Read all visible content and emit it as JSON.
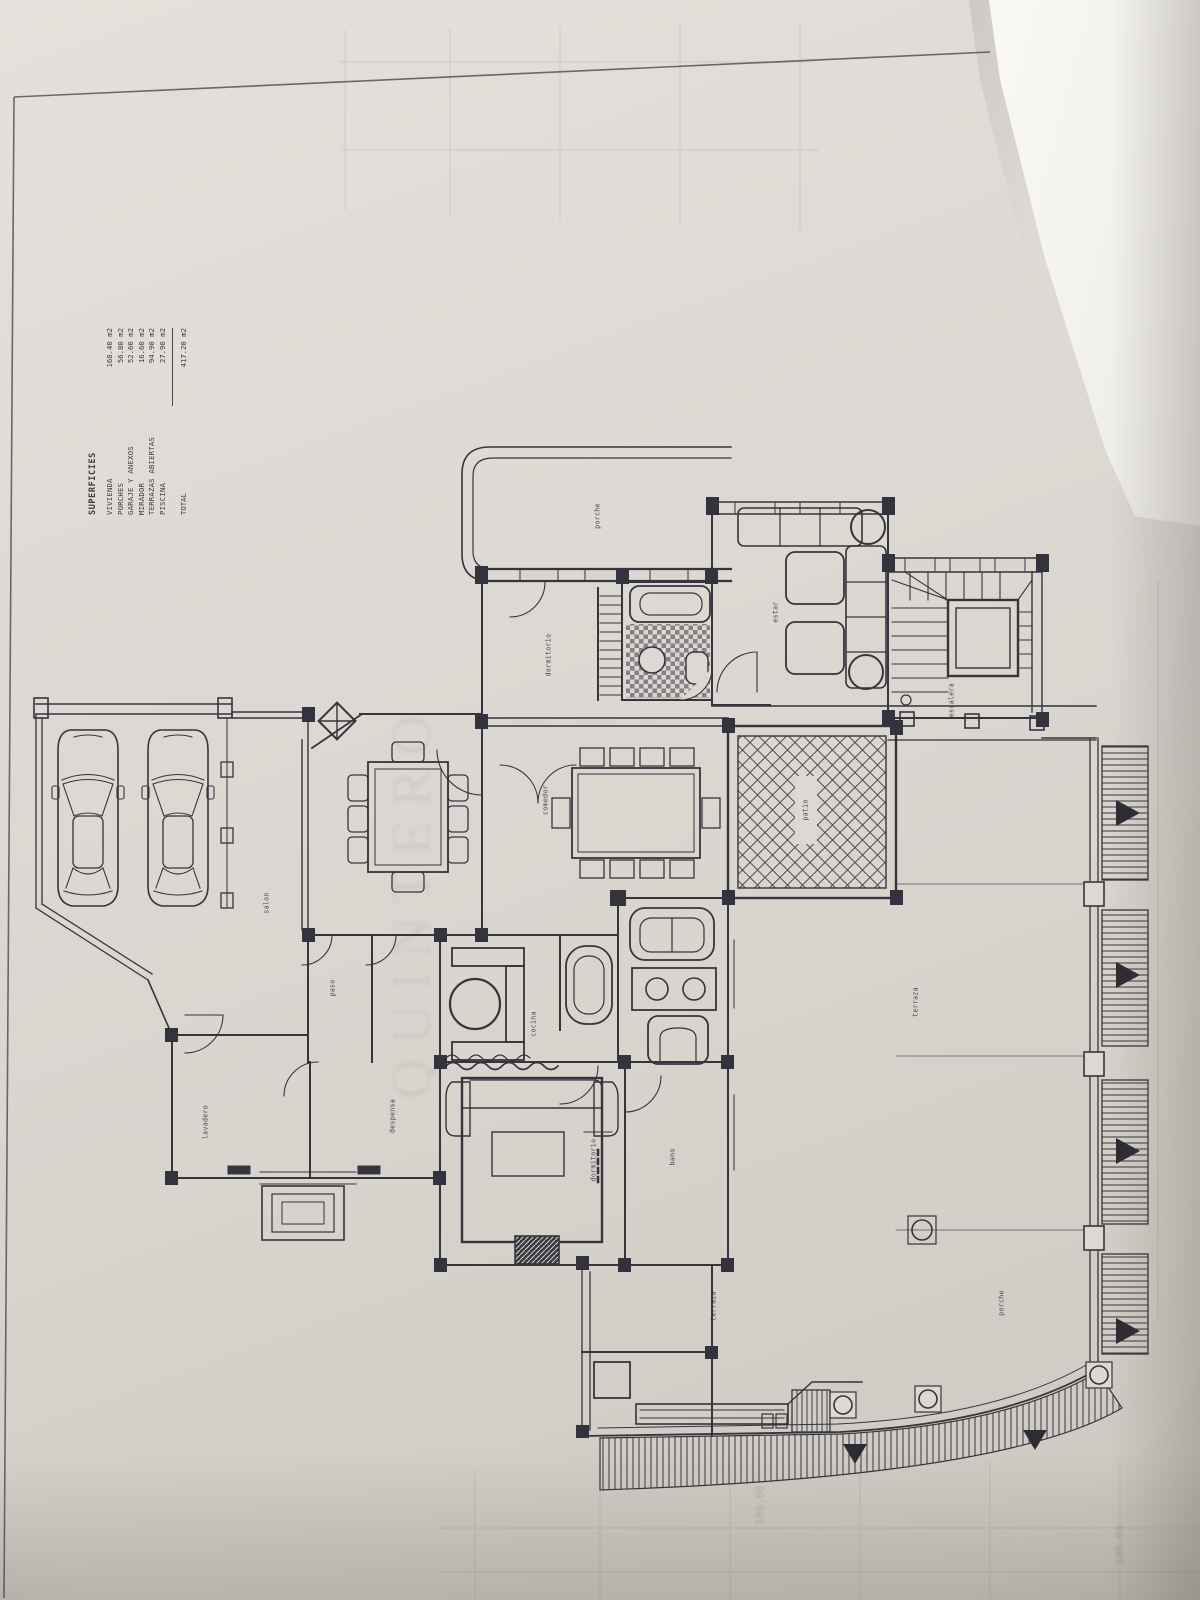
{
  "document": {
    "type": "architectural floor plan, ground floor, scanned photo",
    "orientation": "plan rotated 90 degrees on sheet"
  },
  "colors": {
    "paper": "#dcd8d3",
    "ink": "#36343c",
    "overlay_sheet": "#f7f5f1"
  },
  "legend": {
    "title": "SUPERFICIES",
    "items": [
      {
        "label": "VIVIENDA",
        "value": "168.40 m2"
      },
      {
        "label": "PORCHES",
        "value": "56.80 m2"
      },
      {
        "label": "GARAJE Y ANEXOS",
        "value": "52.60 m2"
      },
      {
        "label": "MIRADOR",
        "value": "16.60 m2"
      },
      {
        "label": "TERRAZAS ABIERTAS",
        "value": "94.90 m2"
      },
      {
        "label": "PISCINA",
        "value": "27.90 m2"
      }
    ],
    "total": {
      "label": "TOTAL",
      "value": "417.20 m2"
    }
  },
  "labels": [
    {
      "text": "porche"
    },
    {
      "text": "dormitorio"
    },
    {
      "text": "estar"
    },
    {
      "text": "escalera"
    },
    {
      "text": "patio"
    },
    {
      "text": "comedor"
    },
    {
      "text": "salon"
    },
    {
      "text": "paso"
    },
    {
      "text": "cocina"
    },
    {
      "text": "lavadero"
    },
    {
      "text": "despensa"
    },
    {
      "text": "dormitorio"
    },
    {
      "text": "bano"
    },
    {
      "text": "terraza"
    },
    {
      "text": "terraza"
    },
    {
      "text": "porche"
    }
  ],
  "watermark": "QUINTERO",
  "bleedthrough": {
    "values": [
      "100.00",
      "100.00"
    ]
  }
}
